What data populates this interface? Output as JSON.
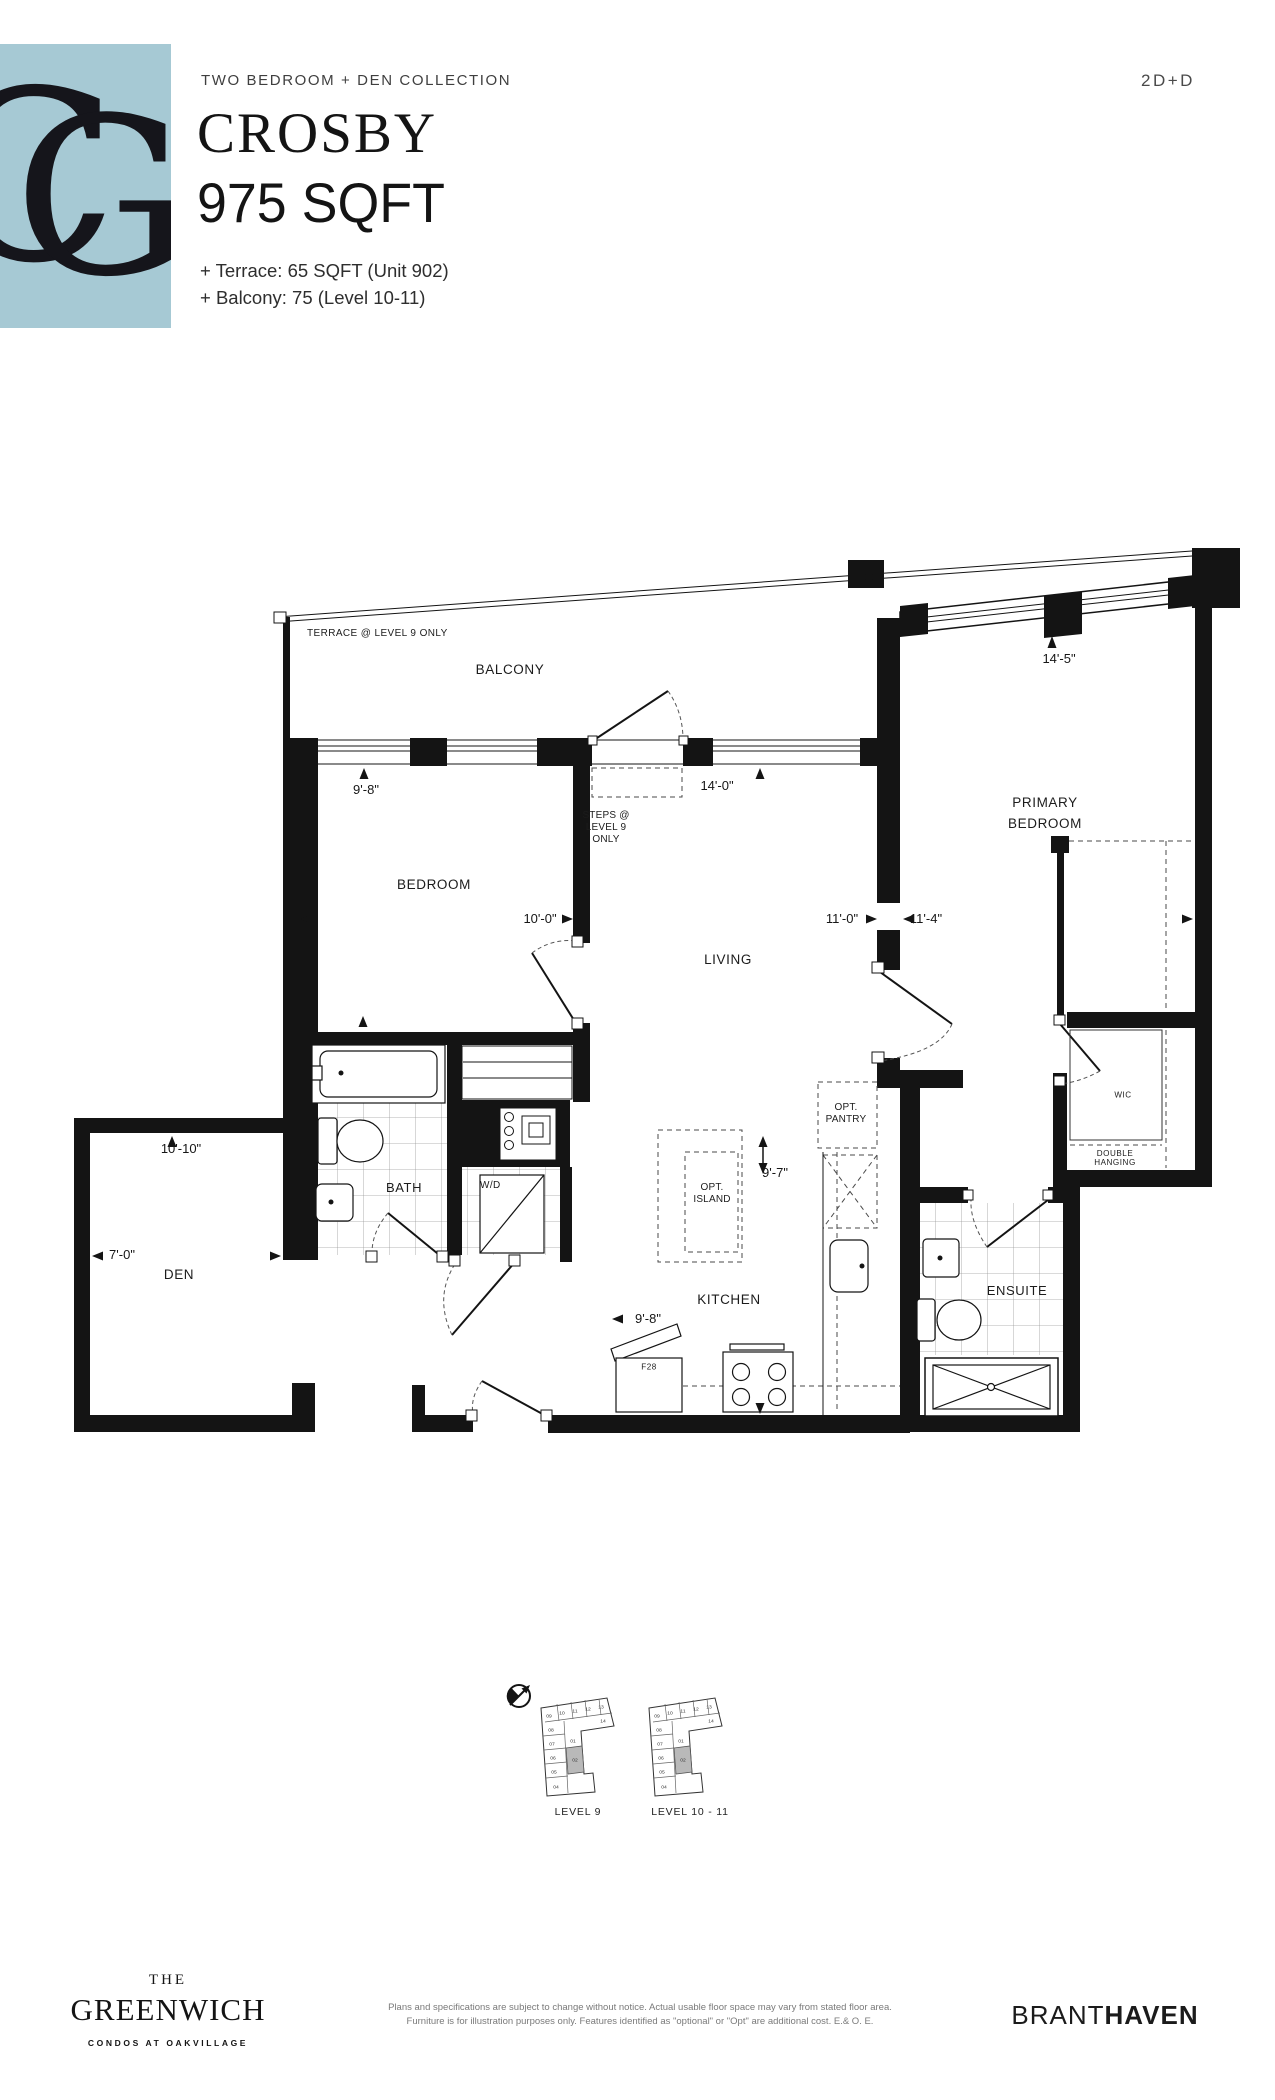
{
  "colors": {
    "accent_blue": "#a6c9d4",
    "ink": "#141414",
    "muted_text": "#7a7a7a",
    "keyplan_highlight": "#b9b9b9"
  },
  "logo": {
    "monogram": [
      "C",
      "G"
    ]
  },
  "header": {
    "eyebrow": "TWO BEDROOM + DEN COLLECTION",
    "plan_code": "2D+D",
    "title_line1": "CROSBY",
    "title_line2": "975 SQFT",
    "extra_line1": "+ Terrace: 65 SQFT (Unit 902)",
    "extra_line2": "+ Balcony: 75 (Level 10-11)"
  },
  "plan": {
    "notes": {
      "terrace": "TERRACE @ LEVEL 9 ONLY",
      "steps": [
        "STEPS @",
        "LEVEL 9",
        "ONLY"
      ]
    },
    "rooms": {
      "balcony": "BALCONY",
      "bedroom": "BEDROOM",
      "primary": [
        "PRIMARY",
        "BEDROOM"
      ],
      "living": "LIVING",
      "den": "DEN",
      "bath": "BATH",
      "kitchen": "KITCHEN",
      "ensuite": "ENSUITE",
      "wic": "WIC",
      "double_hanging": [
        "DOUBLE",
        "HANGING"
      ],
      "opt_pantry": [
        "OPT.",
        "PANTRY"
      ],
      "opt_island": [
        "OPT.",
        "ISLAND"
      ],
      "wd": "W/D",
      "fridge": "F28"
    },
    "dimensions": {
      "bedroom_window": "9'-8\"",
      "balcony_door": "14'-0\"",
      "primary_window": "14'-5\"",
      "bedroom_width": "10'-0\"",
      "living_width": "11'-0\"",
      "primary_width": "11'-4\"",
      "den_width": "10'-10\"",
      "den_depth": "7'-0\"",
      "kitchen_depth": "9'-7\"",
      "kitchen_width": "9'-8\""
    }
  },
  "keyplans": {
    "units": [
      "09",
      "10",
      "11",
      "12",
      "13",
      "14",
      "08",
      "07",
      "06",
      "05",
      "04",
      "01",
      "02"
    ],
    "level9_label": "LEVEL 9",
    "level10_label": "LEVEL 10 - 11"
  },
  "footer": {
    "brand_the": "THE",
    "brand_name": "GREENWICH",
    "brand_sub": "CONDOS AT OAKVILLAGE",
    "disclaimer_line1": "Plans and specifications are subject to change without notice. Actual usable floor space may vary from stated floor area.",
    "disclaimer_line2": "Furniture is for illustration purposes only. Features identified as \"optional\" or \"Opt\" are additional cost. E.& O. E.",
    "developer_part1": "BRANT",
    "developer_part2": "HAVEN"
  }
}
